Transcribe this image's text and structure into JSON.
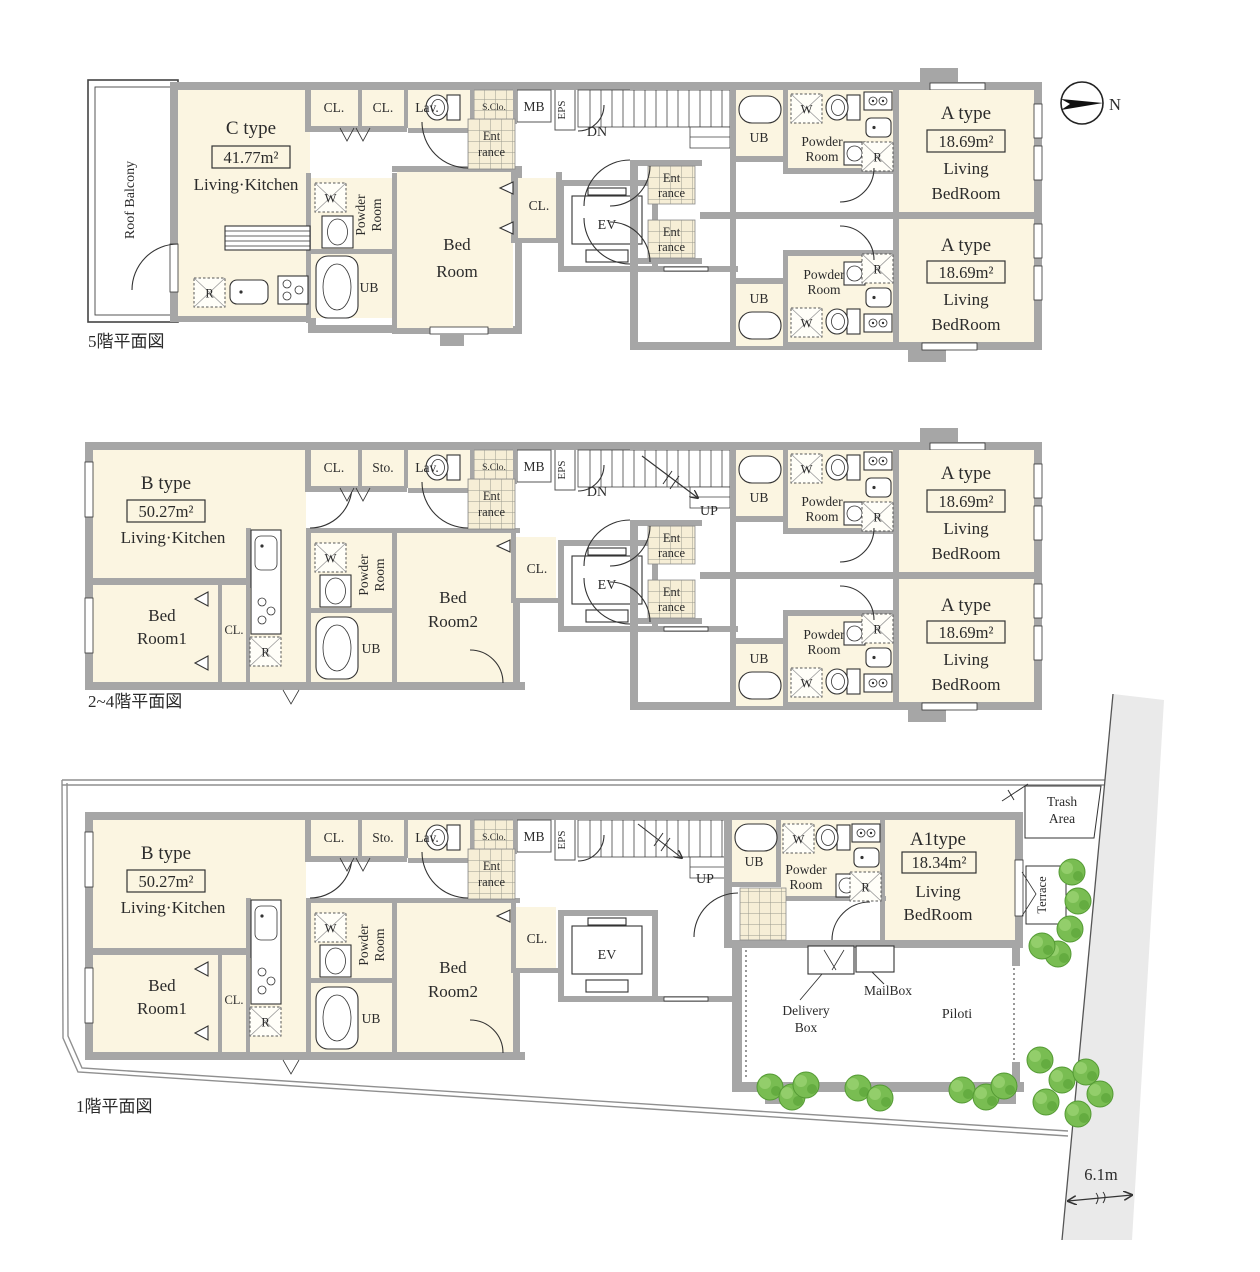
{
  "captions": {
    "floor5": "5階平面図",
    "floor2_4": "2~4階平面図",
    "floor1": "1階平面図"
  },
  "compass": {
    "north": "N"
  },
  "stairs": {
    "down": "DN",
    "up": "UP"
  },
  "rooms": {
    "closet": "CL.",
    "storage": "Sto.",
    "lavatory": "Lav.",
    "shoe_closet": "S.Clo.",
    "mail_box": "MB",
    "eps": "EPS",
    "unit_bath": "UB",
    "powder_l1": "Powder",
    "powder_l2": "Room",
    "entrance_l1": "Ent",
    "entrance_l2": "rance",
    "elevator": "EV",
    "washer": "W",
    "refrigerator": "R"
  },
  "units": {
    "a": {
      "type": "A type",
      "area": "18.69m²",
      "use_l1": "Living",
      "use_l2": "BedRoom"
    },
    "a1": {
      "type": "A1type",
      "area": "18.34m²",
      "use_l1": "Living",
      "use_l2": "BedRoom"
    },
    "b": {
      "type": "B type",
      "area": "50.27m²",
      "use": "Living·Kitchen",
      "bedroom1_l1": "Bed",
      "bedroom1_l2": "Room1",
      "bedroom2_l1": "Bed",
      "bedroom2_l2": "Room2"
    },
    "c": {
      "type": "C type",
      "area": "41.77m²",
      "use": "Living·Kitchen",
      "bedroom_l1": "Bed",
      "bedroom_l2": "Room",
      "roof_balcony": "Roof Balcony"
    }
  },
  "site": {
    "trash_l1": "Trash",
    "trash_l2": "Area",
    "terrace": "Terrace",
    "mail_box": "MailBox",
    "delivery_l1": "Delivery",
    "delivery_l2": "Box",
    "piloti": "Piloti",
    "road_width": "6.1m"
  }
}
